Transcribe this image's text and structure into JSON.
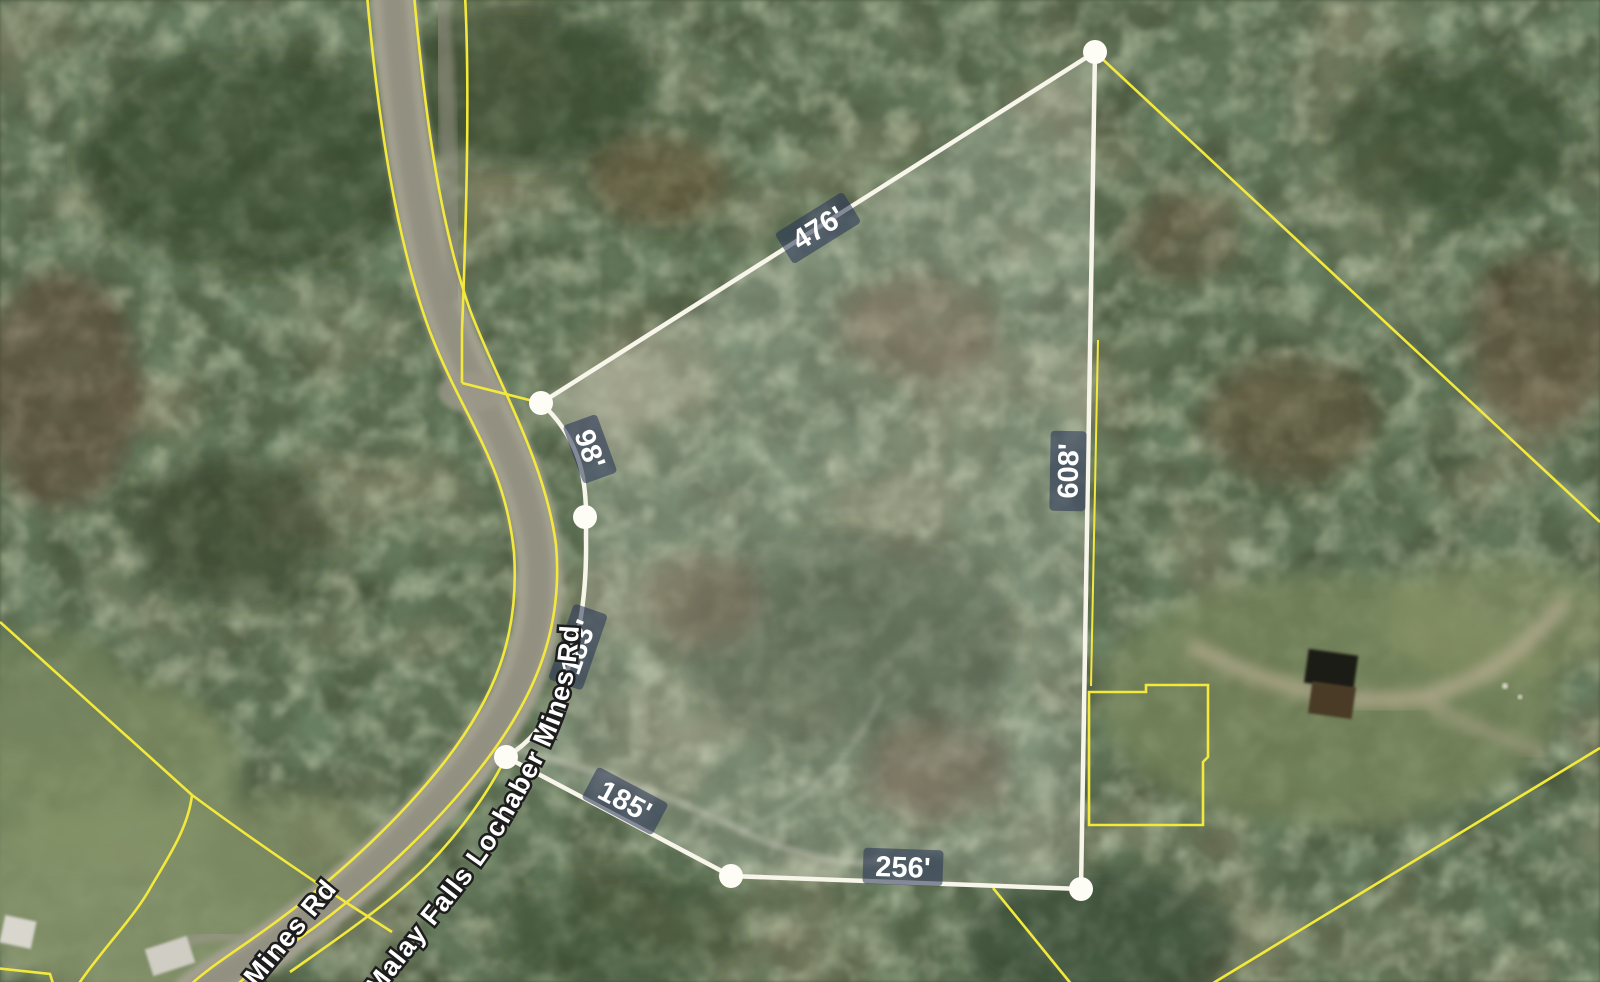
{
  "map": {
    "description": "Aerial parcel viewer showing a highlighted survey parcel with side measurements",
    "parcel": {
      "sides": [
        {
          "name": "northwest-side",
          "length_label": "476'"
        },
        {
          "name": "road-frontage-upper",
          "length_label": "98'"
        },
        {
          "name": "road-frontage-lower",
          "length_label": "183'"
        },
        {
          "name": "southwest-side",
          "length_label": "185'"
        },
        {
          "name": "south-side",
          "length_label": "256'"
        },
        {
          "name": "east-side",
          "length_label": "608'"
        }
      ],
      "vertex_count": 6
    },
    "roads": [
      {
        "label": "Malay Falls Lochaber Mines Rd"
      },
      {
        "label": "Mines Rd"
      }
    ],
    "colors": {
      "parcel_line_yellow": "#f3e93c",
      "highlight_white": "#f8f6ea",
      "label_badge_blue": "#263256",
      "road_surface": "#a3a08f"
    }
  }
}
